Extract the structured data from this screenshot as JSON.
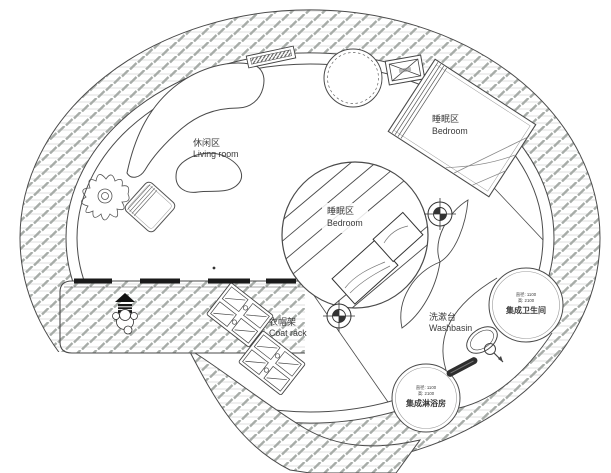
{
  "page": {
    "type": "architectural floor plan (round tiny-house)"
  },
  "labels": {
    "living": {
      "zh": "休闲区",
      "en": "Living room"
    },
    "bedroom_loft": {
      "zh": "睡眠区",
      "en": "Bedroom"
    },
    "bedroom_main": {
      "zh": "睡眠区",
      "en": "Bedroom"
    },
    "coat_rack": {
      "zh": "衣帽架",
      "en": "Coat rack"
    },
    "washbasin": {
      "zh": "洗漱台",
      "en": "Washbasin"
    },
    "bathroom_pod": {
      "name": "集成卫生间",
      "dim_line1": "直径: 1100",
      "dim_line2": "高: 2100"
    },
    "shower_pod": {
      "name": "集成淋浴房",
      "dim_line1": "直径: 1100",
      "dim_line2": "高: 2100"
    }
  },
  "colors": {
    "background": "#ffffff",
    "wall_line": "#4a4a4a",
    "hatch_dash": "#a7aca8",
    "hatch_line": "#dcdcdc",
    "glazing_black": "#1a1a1a"
  }
}
